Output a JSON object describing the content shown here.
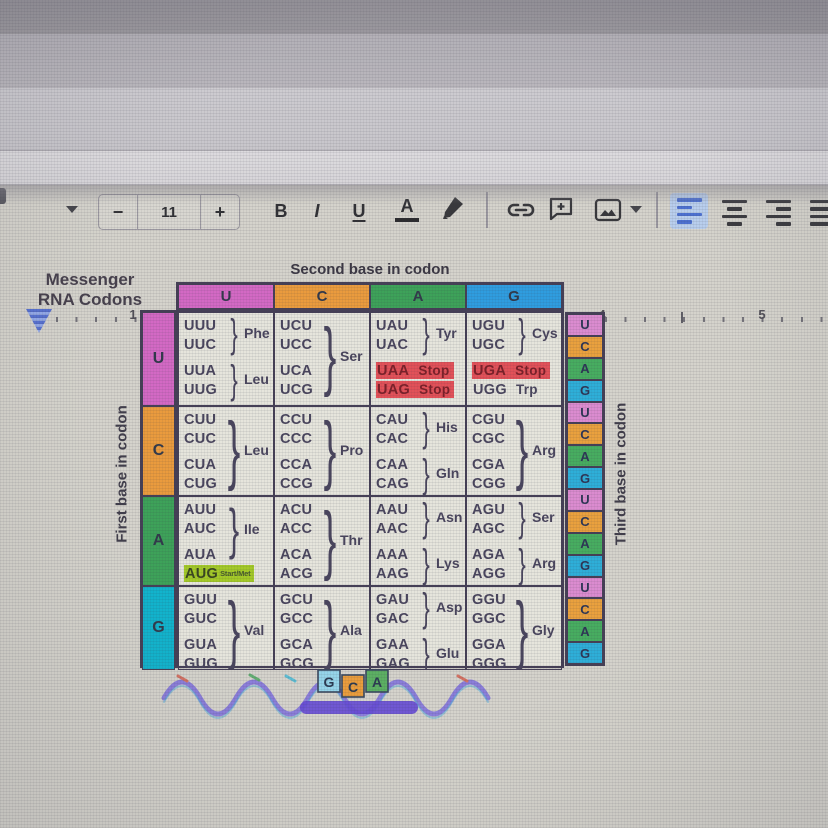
{
  "colors": {
    "accent_blue": "#4066cc",
    "base_u_pink": "#d05ec0",
    "base_c_orange": "#e8942f",
    "base_a_green": "#2f9b4d",
    "base_g_blue": "#2096dd",
    "base_g_cyan": "#00aec9",
    "stop_highlight_red": "#e0444c",
    "start_highlight_green": "#9dc618",
    "cell_background": "#e4e3da"
  },
  "menu": {
    "help": "Help",
    "last_edit": "Last edit was 9 minutes ago"
  },
  "toolbar": {
    "font_size": "11",
    "decrease": "−",
    "increase": "+",
    "bold": "B",
    "italic": "I",
    "underline": "U",
    "text_color": "A"
  },
  "ruler": {
    "marks": [
      "1",
      "2",
      "3",
      "4",
      "5"
    ]
  },
  "table": {
    "heading": "Messenger\nRNA Codons",
    "second_base_label": "Second base in codon",
    "first_base_label": "First base in codon",
    "third_base_label": "Third base in codon",
    "brace": "}",
    "column_bases": [
      "U",
      "C",
      "A",
      "G"
    ],
    "row_bases": [
      "U",
      "C",
      "A",
      "G"
    ],
    "third_bases": [
      "U",
      "C",
      "A",
      "G"
    ],
    "rows": [
      {
        "cells": [
          {
            "l": [
              "UUU",
              "UUC",
              "UUA",
              "UUG"
            ],
            "aa": [
              "Phe",
              "Leu"
            ]
          },
          {
            "l": [
              "UCU",
              "UCC",
              "UCA",
              "UCG"
            ],
            "aa": [
              "Ser"
            ]
          },
          {
            "l": [
              "UAU",
              "UAC",
              "UAA",
              "UAG"
            ],
            "t": [
              "",
              "",
              "Stop",
              "Stop"
            ],
            "aa": [
              "Tyr"
            ]
          },
          {
            "l": [
              "UGU",
              "UGC",
              "UGA",
              "UGG"
            ],
            "t": [
              "",
              "",
              "Stop",
              "Trp"
            ],
            "aa": [
              "Cys"
            ]
          }
        ]
      },
      {
        "cells": [
          {
            "l": [
              "CUU",
              "CUC",
              "CUA",
              "CUG"
            ],
            "aa": [
              "Leu"
            ]
          },
          {
            "l": [
              "CCU",
              "CCC",
              "CCA",
              "CCG"
            ],
            "aa": [
              "Pro"
            ]
          },
          {
            "l": [
              "CAU",
              "CAC",
              "CAA",
              "CAG"
            ],
            "aa": [
              "His",
              "Gln"
            ]
          },
          {
            "l": [
              "CGU",
              "CGC",
              "CGA",
              "CGG"
            ],
            "aa": [
              "Arg"
            ]
          }
        ]
      },
      {
        "cells": [
          {
            "l": [
              "AUU",
              "AUC",
              "AUA",
              "AUG"
            ],
            "t": [
              "",
              "",
              "",
              "Start/Met"
            ],
            "aa": [
              "Ile"
            ]
          },
          {
            "l": [
              "ACU",
              "ACC",
              "ACA",
              "ACG"
            ],
            "aa": [
              "Thr"
            ]
          },
          {
            "l": [
              "AAU",
              "AAC",
              "AAA",
              "AAG"
            ],
            "aa": [
              "Asn",
              "Lys"
            ]
          },
          {
            "l": [
              "AGU",
              "AGC",
              "AGA",
              "AGG"
            ],
            "aa": [
              "Ser",
              "Arg"
            ]
          }
        ]
      },
      {
        "cells": [
          {
            "l": [
              "GUU",
              "GUC",
              "GUA",
              "GUG"
            ],
            "aa": [
              "Val"
            ]
          },
          {
            "l": [
              "GCU",
              "GCC",
              "GCA",
              "GCG"
            ],
            "aa": [
              "Ala"
            ]
          },
          {
            "l": [
              "GAU",
              "GAC",
              "GAA",
              "GAG"
            ],
            "aa": [
              "Asp",
              "Glu"
            ]
          },
          {
            "l": [
              "GGU",
              "GGC",
              "GGA",
              "GGG"
            ],
            "aa": [
              "Gly"
            ]
          }
        ]
      }
    ]
  },
  "decoration": {
    "bases": [
      "G",
      "C",
      "A"
    ]
  }
}
